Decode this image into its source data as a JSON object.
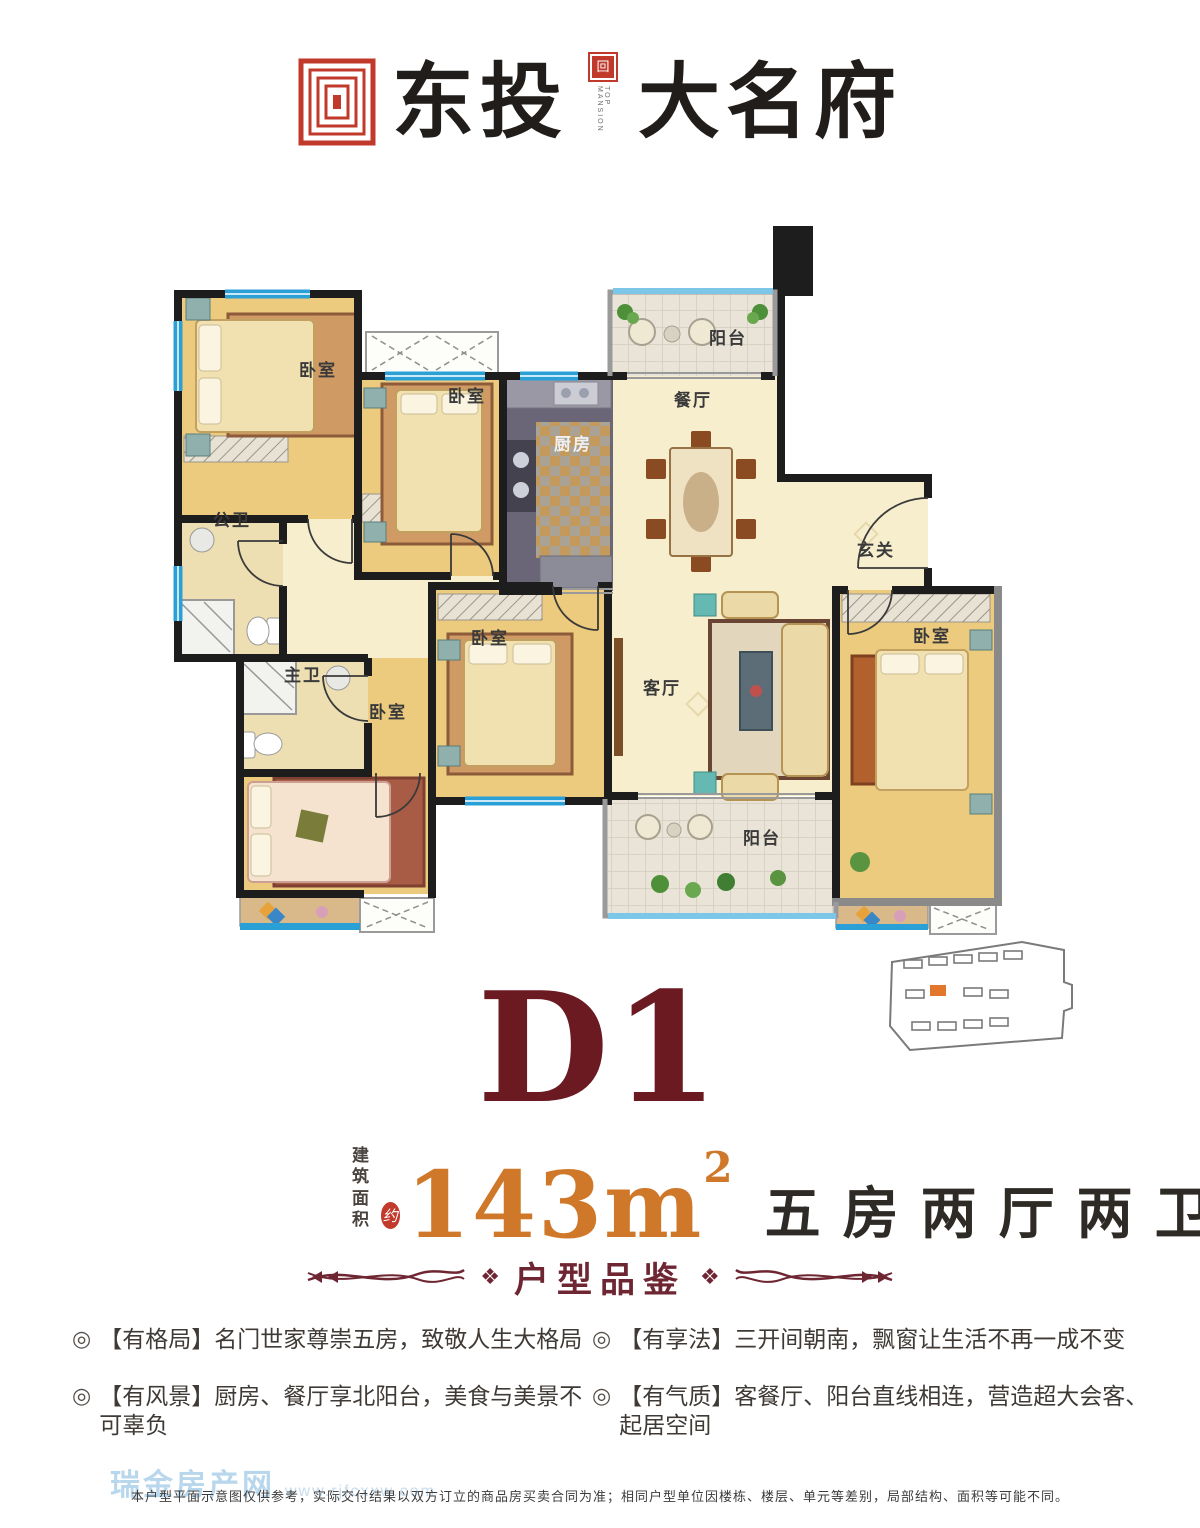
{
  "logo": {
    "brand": "东投",
    "project": "大名府",
    "seal_label": "TOP MANSION"
  },
  "plan": {
    "labels": {
      "bedroom": "卧室",
      "kitchen": "厨房",
      "dining": "餐厅",
      "living": "客厅",
      "balcony": "阳台",
      "entry": "玄关",
      "public_bath": "公卫",
      "master_bath": "主卫"
    }
  },
  "unit": {
    "name": "D1",
    "area_prefix_line1": "建筑",
    "area_prefix_line2": "面积",
    "approx": "约",
    "area_value": "143m",
    "area_sup": "2",
    "layout_desc": "五房两厅两卫"
  },
  "section": {
    "title": "户型品鉴",
    "ornament": "❖"
  },
  "features": {
    "bullet": "◎",
    "items": [
      "【有格局】名门世家尊崇五房，致敬人生大格局",
      "【有风景】厨房、餐厅享北阳台，美食与美景不可辜负",
      "【有享法】三开间朝南，飘窗让生活不再一成不变",
      "【有气质】客餐厅、阳台直线相连，营造超大会客、起居空间"
    ]
  },
  "watermark": {
    "site_name": "瑞金房产网",
    "site_url": "www.rjfcxxw.com"
  },
  "disclaimer": "本户型平面示意图仅供参考，实际交付结果以双方订立的商品房买卖合同为准；相同户型单位因楼栋、楼层、单元等差别，局部结构、面积等可能不同。",
  "colors": {
    "title_maroon": "#6b1a22",
    "accent_orange": "#d0782a",
    "seal_red": "#c0392b",
    "divider_maroon": "#6e2633",
    "watermark_blue": "#b9d7ec",
    "wall_black": "#1d1d1d",
    "window_blue": "#2aa0d6"
  }
}
